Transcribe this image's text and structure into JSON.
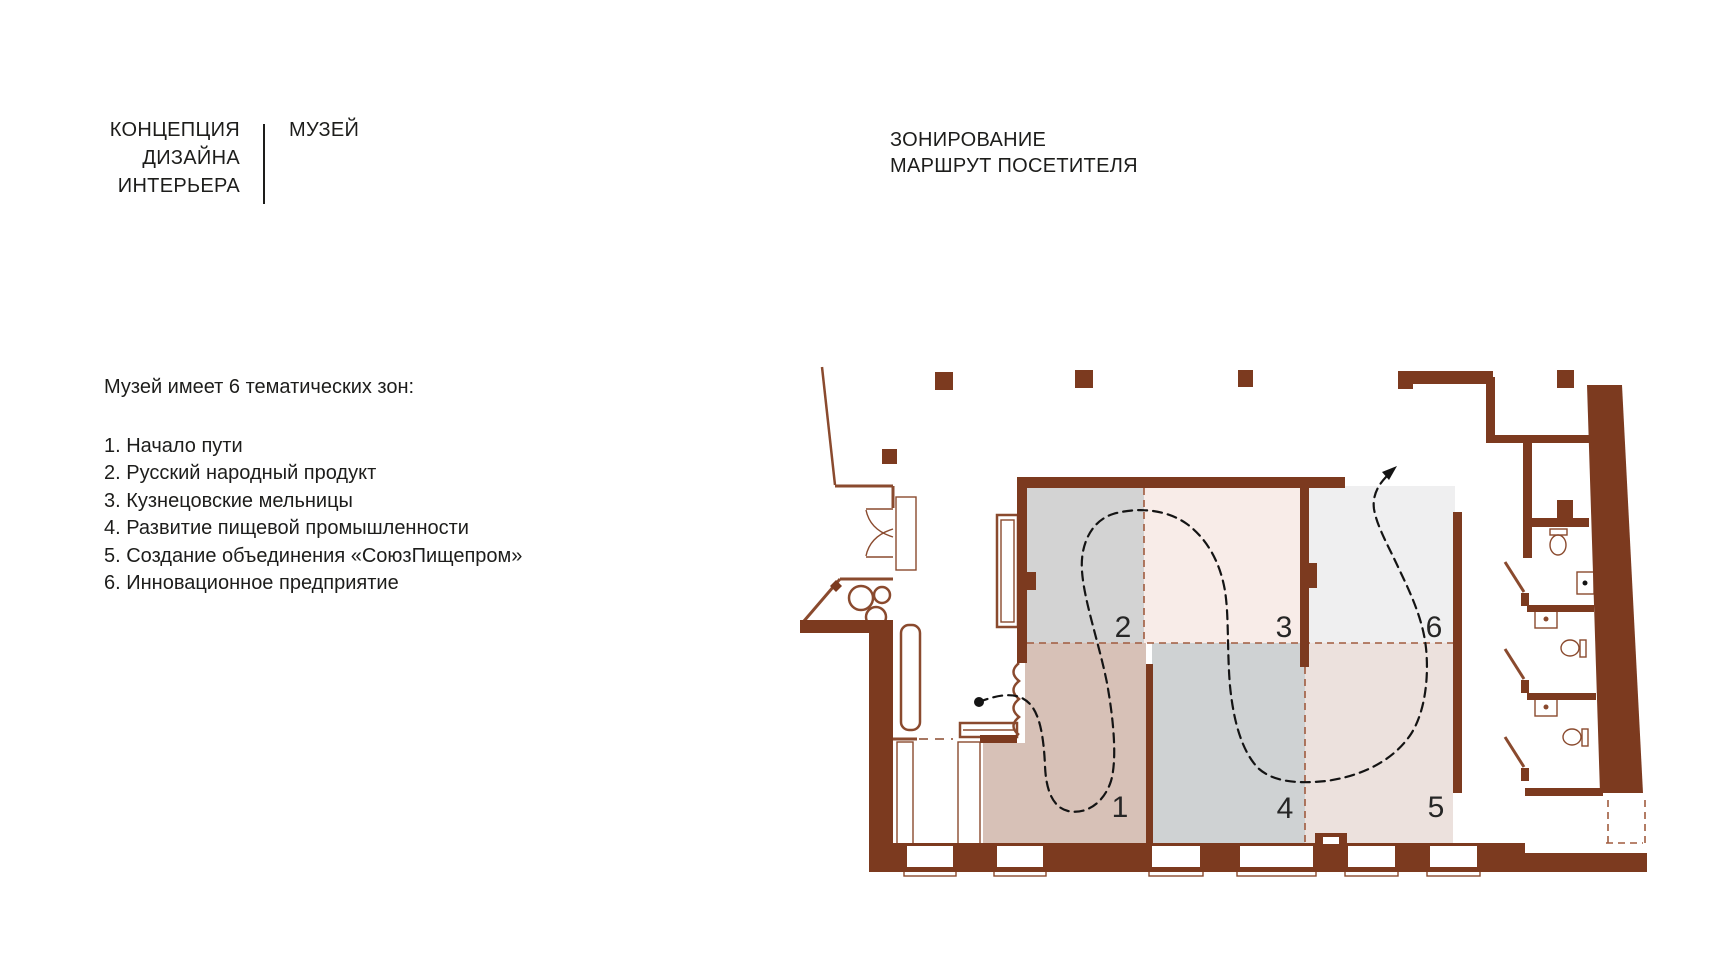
{
  "header": {
    "brand_lines": [
      "КОНЦЕПЦИЯ",
      "ДИЗАЙНА",
      "ИНТЕРЬЕРА"
    ],
    "brand_suffix": "МУЗЕЙ",
    "section_title_lines": [
      "ЗОНИРОВАНИЕ",
      "МАРШРУТ ПОСЕТИТЕЛЯ"
    ]
  },
  "legend": {
    "intro": "Музей имеет 6 тематических зон:",
    "items": [
      "1. Начало пути",
      "2. Русский народный продукт",
      "3. Кузнецовские мельницы",
      "4. Развитие пищевой промышленности",
      "5. Создание объединения «СоюзПищепром»",
      "6. Инновационное предприятие"
    ]
  },
  "plan": {
    "zones": [
      {
        "label": "1",
        "fill": "#d7c1b7"
      },
      {
        "label": "2",
        "fill": "#d3d3d3"
      },
      {
        "label": "3",
        "fill": "#f8ece8"
      },
      {
        "label": "4",
        "fill": "#cfd2d3"
      },
      {
        "label": "5",
        "fill": "#ece1dd"
      },
      {
        "label": "6",
        "fill": "#efeff0"
      }
    ],
    "route": {
      "start": "entrance-dot",
      "end": "exit-arrow-top-right"
    }
  },
  "colors": {
    "wall": "#7c3a1f",
    "wall_light": "#8a4a2e",
    "divider": "#a05b3e",
    "route": "#141414",
    "text": "#1d1d1b",
    "background": "#ffffff"
  }
}
